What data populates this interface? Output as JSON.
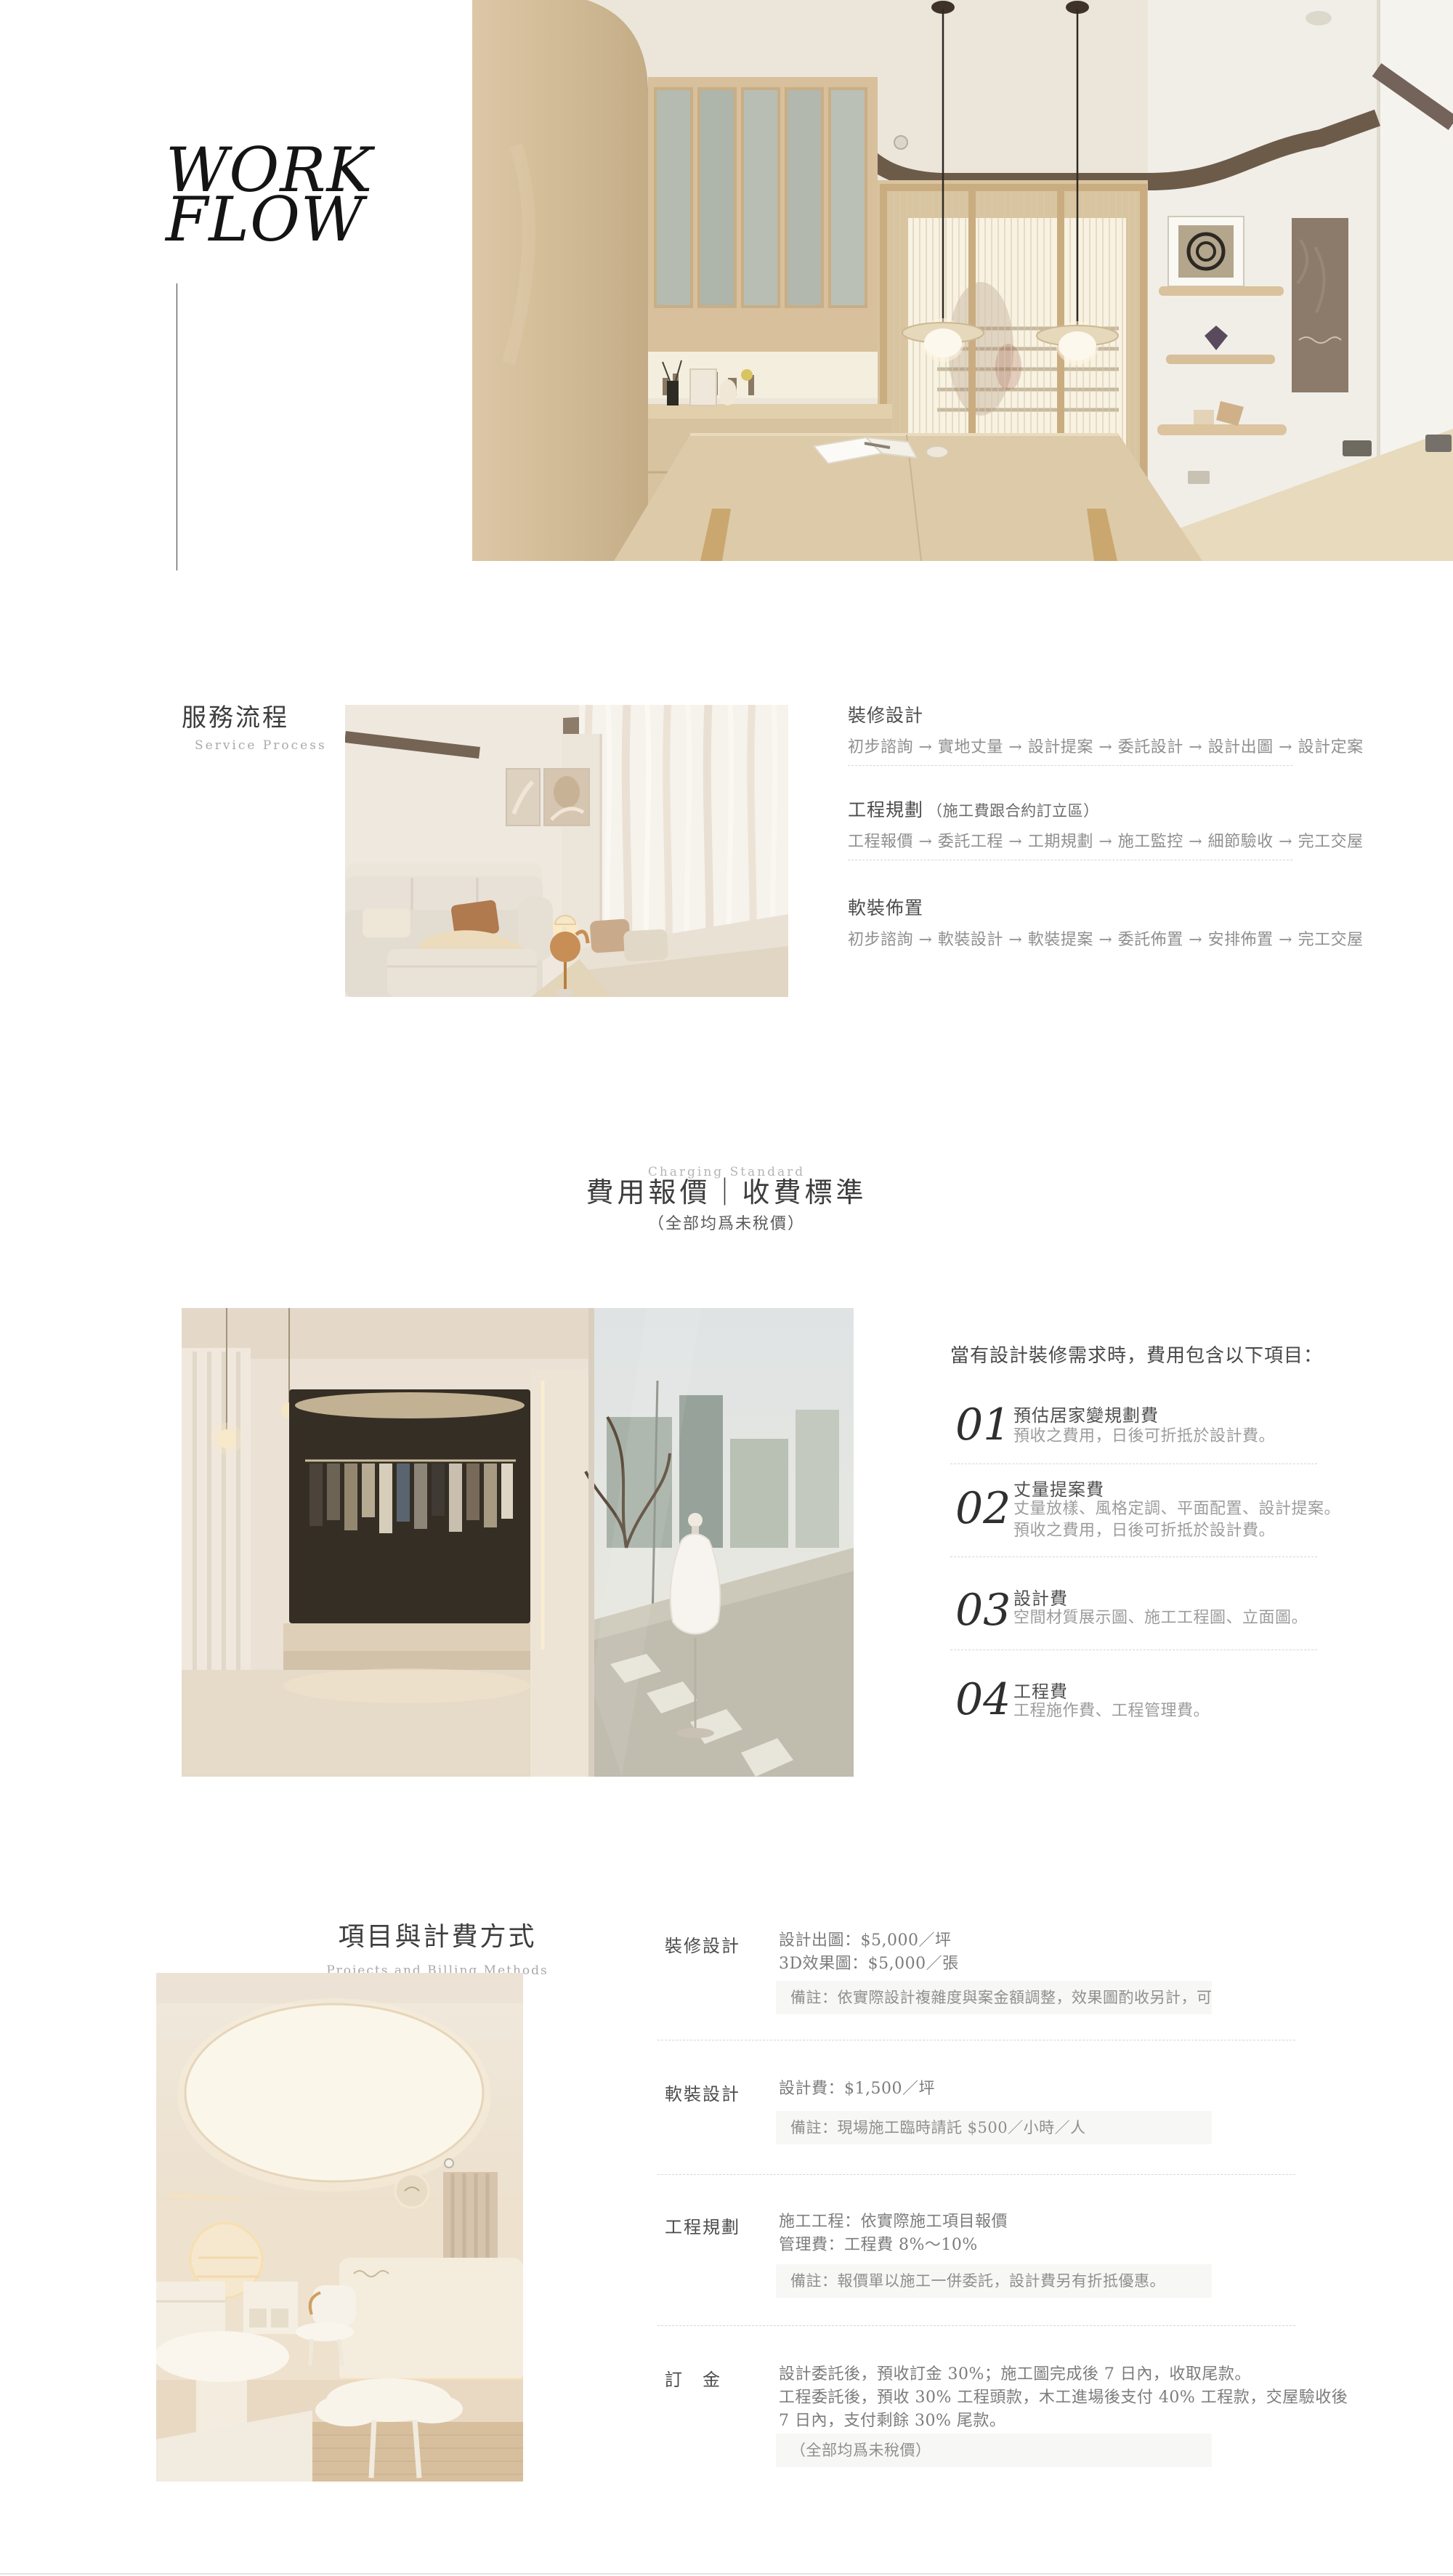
{
  "hero": {
    "title_line1": "WORK",
    "title_line2": "FLOW"
  },
  "service_process": {
    "title": "服務流程",
    "subtitle": "Service Process",
    "flows": [
      {
        "title": "裝修設計",
        "note": "",
        "steps": "初步諮詢 → 實地丈量 → 設計提案 → 委託設計 → 設計出圖 → 設計定案"
      },
      {
        "title": "工程規劃",
        "note": "（施工費跟合約訂立區）",
        "steps": "工程報價 → 委託工程 → 工期規劃 → 施工監控 → 細節驗收 → 完工交屋"
      },
      {
        "title": "軟裝佈置",
        "note": "",
        "steps": "初步諮詢 → 軟裝設計 → 軟裝提案 → 委託佈置 → 安排佈置 → 完工交屋"
      }
    ]
  },
  "charging_standard": {
    "eyebrow": "Charging Standard",
    "title": "費用報價｜收費標準",
    "subtitle": "（全部均爲未稅價）"
  },
  "fee_items": {
    "heading": "當有設計裝修需求時，費用包含以下項目：",
    "items": [
      {
        "number": "01",
        "title": "預估居家變規劃費",
        "lines": [
          "預收之費用，日後可折抵於設計費。"
        ]
      },
      {
        "number": "02",
        "title": "丈量提案費",
        "lines": [
          "丈量放樣、風格定調、平面配置、設計提案。",
          "預收之費用，日後可折抵於設計費。"
        ]
      },
      {
        "number": "03",
        "title": "設計費",
        "lines": [
          "空間材質展示圖、施工工程圖、立面圖。"
        ]
      },
      {
        "number": "04",
        "title": "工程費",
        "lines": [
          "工程施作費、工程管理費。"
        ]
      }
    ]
  },
  "billing": {
    "title": "項目與計費方式",
    "subtitle": "Projects and Billing Methods",
    "rows": [
      {
        "label": "裝修設計",
        "lines": [
          "設計出圖：$5,000／坪",
          "3D效果圖：$5,000／張"
        ],
        "note": "備註：依實際設計複雜度與案金額調整，效果圖酌收另計，可免費修改一次。"
      },
      {
        "label": "軟裝設計",
        "lines": [
          "設計費：$1,500／坪"
        ],
        "note": "備註：現場施工臨時請託 $500／小時／人"
      },
      {
        "label": "工程規劃",
        "lines": [
          "施工工程：依實際施工項目報價",
          "管理費：工程費 8%～10%"
        ],
        "note": "備註：報價單以施工一併委託，設計費另有折抵優惠。"
      },
      {
        "label": "訂　金",
        "lines": [
          "設計委託後，預收訂金 30%；施工圖完成後 7 日內，收取尾款。",
          "工程委託後，預收 30% 工程頭款，木工進場後支付 40% 工程款，交屋驗收後",
          "7 日內，支付剩餘 30% 尾款。"
        ],
        "note": "（全部均爲未稅價）"
      }
    ]
  },
  "colors": {
    "accent_beige": "#d0ba95",
    "trim_brown": "#6d5b4a",
    "text_dark": "#3c3c3c",
    "text_muted": "#8f8f8f",
    "divider": "#d5d5d5",
    "note_bg": "#f7f7f6"
  }
}
